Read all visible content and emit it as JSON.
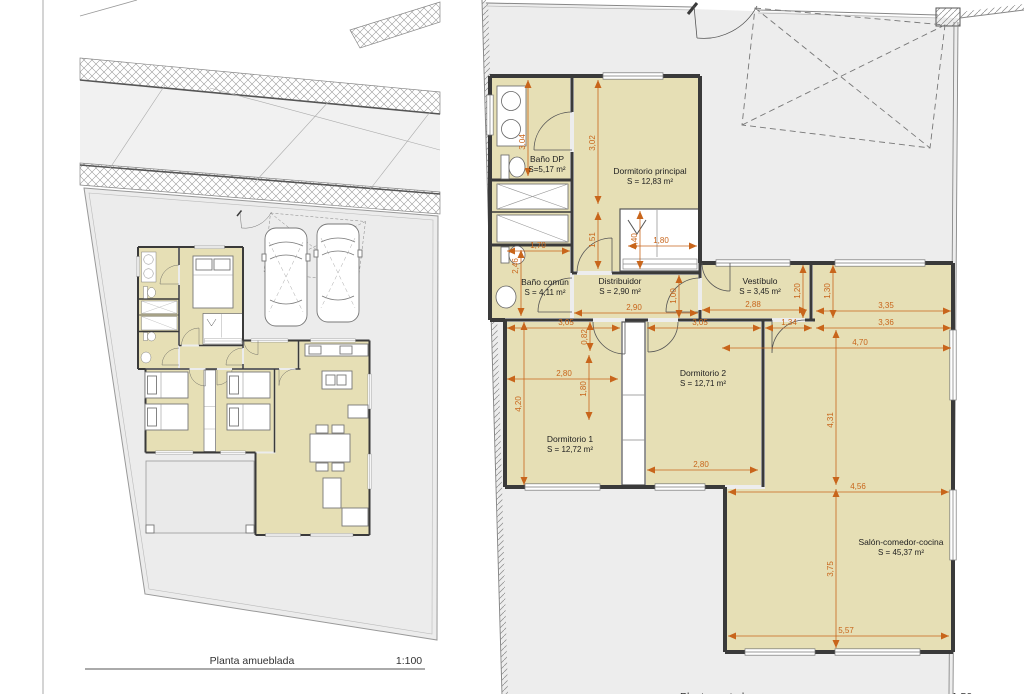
{
  "colors": {
    "room_fill": "#e6dfb5",
    "wall": "#3a3a3a",
    "dimension": "#c8651b",
    "parcel_fill": "#ececec",
    "road_fill": "#f1f1f1",
    "boundary": "#8a8a8a",
    "title_text": "#333333"
  },
  "left_plan": {
    "title": "Planta amueblada",
    "scale": "1:100"
  },
  "right_plan": {
    "title": "Planta acotada",
    "scale": "1:50",
    "rooms": [
      {
        "name": "Baño DP",
        "area": "S=5,17 m²",
        "x": 547,
        "y": 162
      },
      {
        "name": "Dormitorio principal",
        "area": "S = 12,83 m²",
        "x": 650,
        "y": 174
      },
      {
        "name": "Baño común",
        "area": "S = 4,11 m²",
        "x": 545,
        "y": 285
      },
      {
        "name": "Distribuidor",
        "area": "S = 2,90 m²",
        "x": 620,
        "y": 284
      },
      {
        "name": "Vestíbulo",
        "area": "S = 3,45 m²",
        "x": 760,
        "y": 284
      },
      {
        "name": "Dormitorio 1",
        "area": "S = 12,72 m²",
        "x": 570,
        "y": 442
      },
      {
        "name": "Dormitorio 2",
        "area": "S = 12,71 m²",
        "x": 703,
        "y": 376
      },
      {
        "name": "Salón-comedor-cocina",
        "area": "S = 45,37 m²",
        "x": 901,
        "y": 545
      }
    ],
    "dims": [
      {
        "v": "3,04",
        "x1": 528,
        "y1": 80,
        "x2": 528,
        "y2": 176,
        "lx": 525,
        "ly": 142,
        "o": "v"
      },
      {
        "v": "3,02",
        "x1": 598,
        "y1": 80,
        "x2": 598,
        "y2": 204,
        "lx": 595,
        "ly": 143,
        "o": "v"
      },
      {
        "v": "1,51",
        "x1": 598,
        "y1": 212,
        "x2": 598,
        "y2": 269,
        "lx": 595,
        "ly": 240,
        "o": "v"
      },
      {
        "v": "1,40",
        "x1": 640,
        "y1": 211,
        "x2": 640,
        "y2": 269,
        "lx": 637,
        "ly": 241,
        "o": "v"
      },
      {
        "v": "2,46",
        "x1": 521,
        "y1": 250,
        "x2": 521,
        "y2": 316,
        "lx": 518,
        "ly": 266,
        "o": "v"
      },
      {
        "v": "1,70",
        "x1": 507,
        "y1": 251,
        "x2": 570,
        "y2": 251,
        "lx": 538,
        "ly": 248,
        "o": "h"
      },
      {
        "v": "1,80",
        "x1": 628,
        "y1": 246,
        "x2": 697,
        "y2": 246,
        "lx": 661,
        "ly": 243,
        "o": "h"
      },
      {
        "v": "1,00",
        "x1": 679,
        "y1": 275,
        "x2": 679,
        "y2": 318,
        "lx": 676,
        "ly": 296,
        "o": "v"
      },
      {
        "v": "2,90",
        "x1": 574,
        "y1": 313,
        "x2": 698,
        "y2": 313,
        "lx": 634,
        "ly": 310,
        "o": "h"
      },
      {
        "v": "2,88",
        "x1": 702,
        "y1": 310,
        "x2": 807,
        "y2": 310,
        "lx": 753,
        "ly": 307,
        "o": "h"
      },
      {
        "v": "3,35",
        "x1": 816,
        "y1": 311,
        "x2": 951,
        "y2": 311,
        "lx": 886,
        "ly": 308,
        "o": "h"
      },
      {
        "v": "1,20",
        "x1": 803,
        "y1": 265,
        "x2": 803,
        "y2": 318,
        "lx": 800,
        "ly": 291,
        "o": "v"
      },
      {
        "v": "1,30",
        "x1": 833,
        "y1": 265,
        "x2": 833,
        "y2": 318,
        "lx": 830,
        "ly": 291,
        "o": "v"
      },
      {
        "v": "3,05",
        "x1": 507,
        "y1": 328,
        "x2": 620,
        "y2": 328,
        "lx": 566,
        "ly": 325,
        "o": "h"
      },
      {
        "v": "3,05",
        "x1": 647,
        "y1": 328,
        "x2": 761,
        "y2": 328,
        "lx": 700,
        "ly": 325,
        "o": "h"
      },
      {
        "v": "1,34",
        "x1": 765,
        "y1": 328,
        "x2": 812,
        "y2": 328,
        "lx": 789,
        "ly": 325,
        "o": "h"
      },
      {
        "v": "3,36",
        "x1": 816,
        "y1": 328,
        "x2": 951,
        "y2": 328,
        "lx": 886,
        "ly": 325,
        "o": "h"
      },
      {
        "v": "4,70",
        "x1": 722,
        "y1": 348,
        "x2": 951,
        "y2": 348,
        "lx": 860,
        "ly": 345,
        "o": "h"
      },
      {
        "v": "0,82",
        "x1": 590,
        "y1": 322,
        "x2": 590,
        "y2": 351,
        "lx": 587,
        "ly": 337,
        "o": "v"
      },
      {
        "v": "2,80",
        "x1": 507,
        "y1": 379,
        "x2": 618,
        "y2": 379,
        "lx": 564,
        "ly": 376,
        "o": "h"
      },
      {
        "v": "1,80",
        "x1": 589,
        "y1": 355,
        "x2": 589,
        "y2": 420,
        "lx": 586,
        "ly": 389,
        "o": "v"
      },
      {
        "v": "4,20",
        "x1": 524,
        "y1": 322,
        "x2": 524,
        "y2": 485,
        "lx": 521,
        "ly": 404,
        "o": "v"
      },
      {
        "v": "4,31",
        "x1": 836,
        "y1": 330,
        "x2": 836,
        "y2": 485,
        "lx": 833,
        "ly": 420,
        "o": "v"
      },
      {
        "v": "2,80",
        "x1": 647,
        "y1": 470,
        "x2": 758,
        "y2": 470,
        "lx": 701,
        "ly": 467,
        "o": "h"
      },
      {
        "v": "4,56",
        "x1": 728,
        "y1": 492,
        "x2": 949,
        "y2": 492,
        "lx": 858,
        "ly": 489,
        "o": "h"
      },
      {
        "v": "3,75",
        "x1": 836,
        "y1": 489,
        "x2": 836,
        "y2": 648,
        "lx": 833,
        "ly": 569,
        "o": "v"
      },
      {
        "v": "5,57",
        "x1": 728,
        "y1": 636,
        "x2": 949,
        "y2": 636,
        "lx": 846,
        "ly": 633,
        "o": "h"
      }
    ]
  }
}
